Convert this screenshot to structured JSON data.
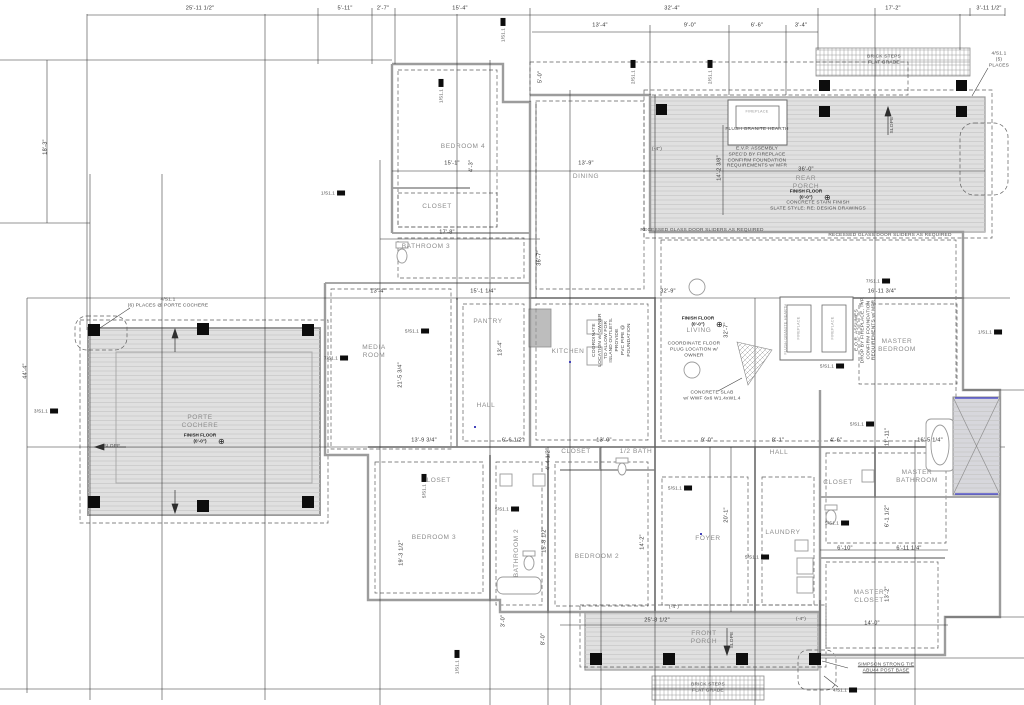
{
  "drawing": {
    "kind": "residential foundation / floor plan",
    "colors": {
      "paper": "#ffffff",
      "walls": "#9c9c9c",
      "thin_lines": "#2e2e2e",
      "dashed_footing": "#5f5f5f",
      "porch_fill": "#e0e0e0",
      "post_fill": "#0d0d0d",
      "shower_accent": "#5555cc"
    }
  },
  "rooms": [
    {
      "name": "bedroom-4",
      "label": "BEDROOM 4",
      "x": 463,
      "y": 147
    },
    {
      "name": "closet-bedroom-4",
      "label": "CLOSET",
      "x": 437,
      "y": 207
    },
    {
      "name": "bathroom-3",
      "label": "BATHROOM 3",
      "x": 426,
      "y": 247
    },
    {
      "name": "dining",
      "label": "DINING",
      "x": 586,
      "y": 177
    },
    {
      "name": "media-room",
      "label": "MEDIA\nROOM",
      "x": 374,
      "y": 352
    },
    {
      "name": "pantry",
      "label": "PANTRY",
      "x": 488,
      "y": 322
    },
    {
      "name": "kitchen",
      "label": "KITCHEN",
      "x": 568,
      "y": 352
    },
    {
      "name": "hall-upper",
      "label": "HALL",
      "x": 486,
      "y": 406
    },
    {
      "name": "living",
      "label": "LIVING",
      "x": 699,
      "y": 331
    },
    {
      "name": "rear-porch",
      "label": "REAR\nPORCH",
      "x": 806,
      "y": 183
    },
    {
      "name": "porte-cochere",
      "label": "PORTE\nCOCHERE",
      "x": 200,
      "y": 422
    },
    {
      "name": "master-bedroom",
      "label": "MASTER\nBEDROOM",
      "x": 897,
      "y": 346
    },
    {
      "name": "master-bathroom",
      "label": "MASTER\nBATHROOM",
      "x": 917,
      "y": 477
    },
    {
      "name": "closet-master-hall",
      "label": "CLOSET",
      "x": 838,
      "y": 483
    },
    {
      "name": "closet-foyer",
      "label": "CLOSET",
      "x": 576,
      "y": 452
    },
    {
      "name": "half-bath",
      "label": "1/2 BATH",
      "x": 636,
      "y": 452
    },
    {
      "name": "master-closet",
      "label": "MASTER\nCLOSET",
      "x": 869,
      "y": 597
    },
    {
      "name": "bedroom-3",
      "label": "BEDROOM 3",
      "x": 434,
      "y": 538
    },
    {
      "name": "closet-bedroom-3",
      "label": "CLOSET",
      "x": 436,
      "y": 481
    },
    {
      "name": "bathroom-2",
      "label": "BATHROOM 2",
      "x": 517,
      "y": 553,
      "rot": 1
    },
    {
      "name": "bedroom-2",
      "label": "BEDROOM 2",
      "x": 597,
      "y": 557
    },
    {
      "name": "foyer",
      "label": "FOYER",
      "x": 708,
      "y": 539
    },
    {
      "name": "laundry",
      "label": "LAUNDRY",
      "x": 783,
      "y": 533
    },
    {
      "name": "hall-lower",
      "label": "HALL",
      "x": 779,
      "y": 453
    },
    {
      "name": "front-porch",
      "label": "FRONT\nPORCH",
      "x": 704,
      "y": 638
    }
  ],
  "dimensions": [
    {
      "text": "25'-11 1/2\"",
      "x": 200,
      "y": 9
    },
    {
      "text": "5'-11\"",
      "x": 345,
      "y": 9
    },
    {
      "text": "2'-7\"",
      "x": 383,
      "y": 9
    },
    {
      "text": "15'-4\"",
      "x": 460,
      "y": 9
    },
    {
      "text": "32'-4\"",
      "x": 672,
      "y": 9
    },
    {
      "text": "17'-2\"",
      "x": 893,
      "y": 9
    },
    {
      "text": "3'-11 1/2\"",
      "x": 989,
      "y": 9
    },
    {
      "text": "13'-4\"",
      "x": 600,
      "y": 26
    },
    {
      "text": "9'-0\"",
      "x": 690,
      "y": 26
    },
    {
      "text": "6'-6\"",
      "x": 757,
      "y": 26
    },
    {
      "text": "3'-4\"",
      "x": 801,
      "y": 26
    },
    {
      "text": "5'-0\"",
      "x": 541,
      "y": 77,
      "rot": 1
    },
    {
      "text": "18'-3\"",
      "x": 46,
      "y": 147,
      "rot": 1
    },
    {
      "text": "44'-4\"",
      "x": 26,
      "y": 371,
      "rot": 1
    },
    {
      "text": "15'-1\"",
      "x": 452,
      "y": 164
    },
    {
      "text": "4'-3\"",
      "x": 472,
      "y": 166,
      "rot": 1
    },
    {
      "text": "13'-9\"",
      "x": 586,
      "y": 164
    },
    {
      "text": "17'-8\"",
      "x": 447,
      "y": 233
    },
    {
      "text": "36'-7\"",
      "x": 540,
      "y": 258,
      "rot": 1
    },
    {
      "text": "14'-2 3/8\"",
      "x": 720,
      "y": 168,
      "rot": 1
    },
    {
      "text": "36'-0\"",
      "x": 806,
      "y": 170
    },
    {
      "text": "13'-4\"",
      "x": 378,
      "y": 292
    },
    {
      "text": "15'-1 1/4\"",
      "x": 483,
      "y": 292
    },
    {
      "text": "32'-9\"",
      "x": 668,
      "y": 292
    },
    {
      "text": "16'-11 3/4\"",
      "x": 882,
      "y": 292
    },
    {
      "text": "21'-5 3/4\"",
      "x": 401,
      "y": 375,
      "rot": 1
    },
    {
      "text": "13'-4\"",
      "x": 501,
      "y": 348,
      "rot": 1
    },
    {
      "text": "32'-7\"",
      "x": 727,
      "y": 330,
      "rot": 1
    },
    {
      "text": "13'-9 3/4\"",
      "x": 424,
      "y": 441
    },
    {
      "text": "6'-6 1/2\"",
      "x": 513,
      "y": 441
    },
    {
      "text": "4'-4 1/2\"",
      "x": 549,
      "y": 459,
      "rot": 1
    },
    {
      "text": "13'-0\"",
      "x": 604,
      "y": 441
    },
    {
      "text": "9'-0\"",
      "x": 707,
      "y": 441
    },
    {
      "text": "8'-1\"",
      "x": 778,
      "y": 441
    },
    {
      "text": "4'-6\"",
      "x": 836,
      "y": 441
    },
    {
      "text": "16'-5 1/4\"",
      "x": 930,
      "y": 441
    },
    {
      "text": "11'-11\"",
      "x": 888,
      "y": 437,
      "rot": 1
    },
    {
      "text": "19'-3 1/2\"",
      "x": 402,
      "y": 553,
      "rot": 1
    },
    {
      "text": "15'-8 1/2\"",
      "x": 545,
      "y": 540,
      "rot": 1
    },
    {
      "text": "14'-2\"",
      "x": 643,
      "y": 542,
      "rot": 1
    },
    {
      "text": "20'-1\"",
      "x": 727,
      "y": 515,
      "rot": 1
    },
    {
      "text": "3'-0\"",
      "x": 504,
      "y": 621,
      "rot": 1
    },
    {
      "text": "8'-0\"",
      "x": 544,
      "y": 639,
      "rot": 1
    },
    {
      "text": "6'-1 1/2\"",
      "x": 888,
      "y": 516,
      "rot": 1
    },
    {
      "text": "6'-10\"",
      "x": 845,
      "y": 549
    },
    {
      "text": "6'-11 1/4\"",
      "x": 909,
      "y": 549
    },
    {
      "text": "13'-2\"",
      "x": 888,
      "y": 594,
      "rot": 1
    },
    {
      "text": "14'-0\"",
      "x": 872,
      "y": 624
    },
    {
      "text": "25'-8 1/2\"",
      "x": 657,
      "y": 621
    }
  ],
  "notes": [
    {
      "name": "porte-cochere-post-callout",
      "text": "4/S1.1\n(6) PLACES @ PORTE COCHERE",
      "x": 168,
      "y": 303
    },
    {
      "name": "rear-porch-post-callout",
      "text": "4/S1.1\n(5) PLACES",
      "x": 999,
      "y": 60
    },
    {
      "name": "brick-steps-rear-note",
      "text": "BRICK STEPS\nFLAT GRADE",
      "x": 884,
      "y": 60
    },
    {
      "name": "brick-steps-front-note",
      "text": "BRICK STEPS\nFLAT GRADE",
      "x": 708,
      "y": 688
    },
    {
      "name": "concrete-stain-note",
      "text": "CONCRETE STAIN FINISH\nSLATE STYLE: RE: DESIGN DRAWINGS",
      "x": 818,
      "y": 206
    },
    {
      "name": "sliders-note-left",
      "text": "RECESSED GLASS DOOR SLIDERS AS REQUIRED",
      "x": 702,
      "y": 231
    },
    {
      "name": "sliders-note-right",
      "text": "RECESSED GLASS DOOR SLIDERS AS REQUIRED",
      "x": 890,
      "y": 236
    },
    {
      "name": "floor-plug-note",
      "text": "COORDINATE FLOOR\nPLUG LOCATION w/\nOWNER",
      "x": 694,
      "y": 350
    },
    {
      "name": "concrete-slab-note",
      "text": "CONCRETE SLAB\nw/ WWF 6x6 W1.4xW1.4",
      "x": 712,
      "y": 396
    },
    {
      "name": "simpson-post-base-note",
      "text": "SIMPSON STRONG TIE\nABU44 POST BASE",
      "x": 886,
      "y": 668,
      "cls": "u"
    },
    {
      "name": "fireplace-assembly-note",
      "text": "E.V.P. ASSEMBLY\nSPEC'D BY FIREPLACE\nCONFIRM FOUNDATION\nREQUIREMENTS w/ MFR",
      "x": 757,
      "y": 158
    },
    {
      "name": "flush-hearth-note",
      "text": "FLUSH GRANITE HEARTH",
      "x": 757,
      "y": 130
    },
    {
      "name": "fireplace-drop-note",
      "text": "E.O.R. ASSUMES\nDROP BY FIREPLACE, TYP.\nCONFIRM FOUNDATION\nREQUIREMENTS w/ MFR",
      "x": 866,
      "y": 330,
      "rot": 1
    },
    {
      "name": "island-outlets-note",
      "text": "COORDINATE\nLOCATION w/ OWNER\nTO ALLOW FOR\nISLAND OUTLETS.\nPROVIDE\nPVC PIPE @\nFOUNDATION",
      "x": 612,
      "y": 340,
      "rot": 1
    },
    {
      "name": "slope-label-porte",
      "text": "SLOPE",
      "x": 112,
      "y": 447
    },
    {
      "name": "slope-label-rear-porch",
      "text": "SLOPE",
      "x": 893,
      "y": 125,
      "rot": 1
    },
    {
      "name": "slope-label-front-porch",
      "text": "SLOPE",
      "x": 733,
      "y": 640,
      "rot": 1
    },
    {
      "name": "spot-elevation-rear",
      "text": "(-4\")",
      "x": 657,
      "y": 150
    },
    {
      "name": "spot-elevation-front-left",
      "text": "(-4\")",
      "x": 674,
      "y": 608
    },
    {
      "name": "spot-elevation-front-right",
      "text": "(-4\")",
      "x": 801,
      "y": 620
    },
    {
      "name": "fireplace-label-left",
      "text": "FIREPLACE",
      "x": 799,
      "y": 328,
      "rot": 1,
      "cls": "tiny"
    },
    {
      "name": "fireplace-label-right",
      "text": "FIREPLACE",
      "x": 833,
      "y": 328,
      "rot": 1,
      "cls": "tiny"
    },
    {
      "name": "fireplace-label-rear",
      "text": "FIREPLACE",
      "x": 757,
      "y": 112,
      "cls": "tiny"
    },
    {
      "name": "hearth-label-master",
      "text": "FLUSH GRANITE HEARTH",
      "x": 786,
      "y": 329,
      "rot": 1,
      "cls": "tiny"
    }
  ],
  "finish_floor_markers": [
    {
      "name": "finish-floor-rear-porch",
      "text": "FINISH FLOOR\n(0'-0\")",
      "x": 806,
      "y": 194
    },
    {
      "name": "finish-floor-living",
      "text": "FINISH FLOOR\n(0'-0\")",
      "x": 698,
      "y": 321
    },
    {
      "name": "finish-floor-porte-cochere",
      "text": "FINISH FLOOR\n(0'-0\")",
      "x": 200,
      "y": 438
    }
  ],
  "flags": [
    {
      "label": "1/S1.1",
      "x": 503,
      "y": 30,
      "rot": 1
    },
    {
      "label": "1/S1.1",
      "x": 441,
      "y": 91,
      "rot": 1
    },
    {
      "label": "2/S1.1",
      "x": 633,
      "y": 72,
      "rot": 1
    },
    {
      "label": "2/S1.1",
      "x": 710,
      "y": 72,
      "rot": 1
    },
    {
      "label": "1/S1.1",
      "x": 333,
      "y": 193
    },
    {
      "label": "3/S1.1",
      "x": 46,
      "y": 411
    },
    {
      "label": "7/S1.1",
      "x": 336,
      "y": 358
    },
    {
      "label": "7/S1.1",
      "x": 878,
      "y": 281
    },
    {
      "label": "1/S1.1",
      "x": 990,
      "y": 332
    },
    {
      "label": "5/S1.1",
      "x": 832,
      "y": 366
    },
    {
      "label": "5/S1.1",
      "x": 862,
      "y": 424
    },
    {
      "label": "5/S1.1",
      "x": 837,
      "y": 523
    },
    {
      "label": "5/S1.1",
      "x": 417,
      "y": 331
    },
    {
      "label": "5/S1.1",
      "x": 507,
      "y": 509
    },
    {
      "label": "5/S1.1",
      "x": 424,
      "y": 486,
      "rot": 1
    },
    {
      "label": "5/S1.1",
      "x": 680,
      "y": 488
    },
    {
      "label": "5/S1.1",
      "x": 757,
      "y": 557
    },
    {
      "label": "1/S1.1",
      "x": 457,
      "y": 662,
      "rot": 1
    },
    {
      "label": "4/S1.1",
      "x": 845,
      "y": 690
    }
  ]
}
